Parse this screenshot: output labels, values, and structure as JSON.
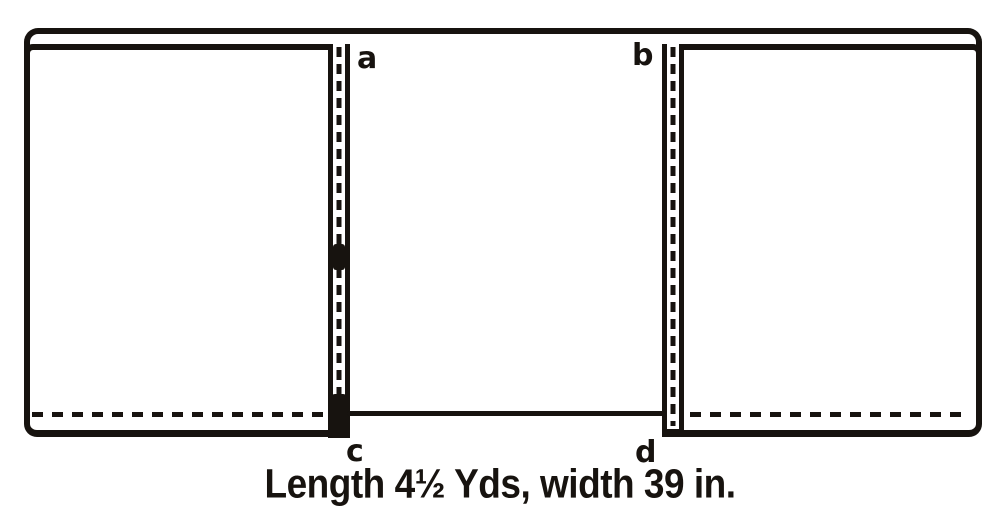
{
  "figure": {
    "labels": {
      "a": "a",
      "b": "b",
      "c": "c",
      "d": "d"
    },
    "caption": "Length 4½ Yds, width 39 in.",
    "colors": {
      "ink": "#17130f",
      "background": "#ffffff"
    }
  }
}
